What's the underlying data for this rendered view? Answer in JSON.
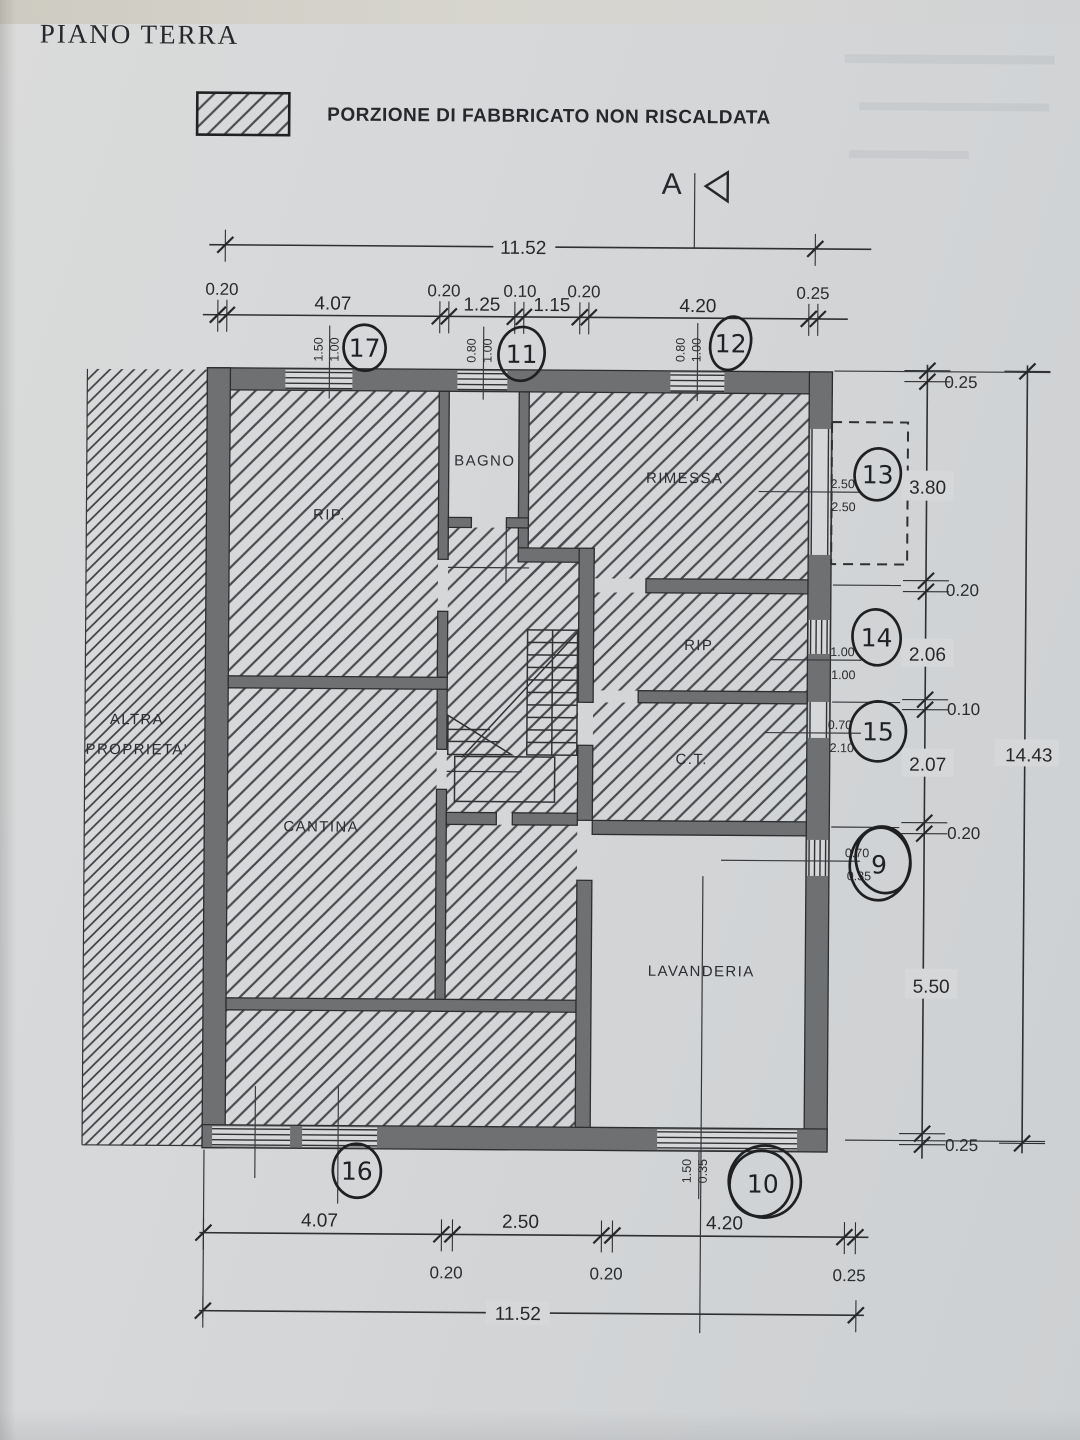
{
  "title": "PIANO TERRA",
  "legend_label": "PORZIONE DI FABBRICATO NON RISCALDATA",
  "section": {
    "label": "A"
  },
  "rooms": {
    "rip1": "RIP.",
    "bagno": "BAGNO",
    "rimessa": "RIMESSA",
    "rip2": "RIP.",
    "ct": "C.T.",
    "cantina": "CANTINA",
    "lavanderia": "LAVANDERIA",
    "altra1": "ALTRA",
    "altra2": "PROPRIETA'"
  },
  "top_dims": {
    "total": "11.52",
    "w1": "0.20",
    "s1": "4.07",
    "w2": "0.20",
    "s2": "1.25",
    "w3": "0.10",
    "s3": "1.15",
    "w4": "0.20",
    "s4": "4.20",
    "w5": "0.25"
  },
  "bottom_dims": {
    "s1": "4.07",
    "s2": "2.50",
    "s3": "4.20",
    "w1": "0.20",
    "w2": "0.20",
    "w3": "0.25",
    "total": "11.52"
  },
  "right_dims": {
    "w1": "0.25",
    "s1": "3.80",
    "w2": "0.20",
    "s2": "2.06",
    "w3": "0.10",
    "s3": "2.07",
    "w4": "0.20",
    "s4": "5.50",
    "w5": "0.25",
    "total": "14.43"
  },
  "openings": {
    "o17": {
      "num": "17",
      "a": "1.50",
      "b": "1.00"
    },
    "o11": {
      "num": "11",
      "a": "0.80",
      "b": "1.00"
    },
    "o12": {
      "num": "12",
      "a": "0.80",
      "b": "1.00"
    },
    "o13": {
      "num": "13",
      "a": "2.50",
      "b": "2.50"
    },
    "o14": {
      "num": "14",
      "a": "1.00",
      "b": "1.00"
    },
    "o15": {
      "num": "15",
      "a": "0.70",
      "b": "2.10"
    },
    "o9": {
      "num": "9",
      "a": "0.70",
      "b": "0.35"
    },
    "o16": {
      "num": "16"
    },
    "o10": {
      "num": "10",
      "a": "1.50",
      "b": "0.35"
    }
  },
  "colors": {
    "paper": "#d4d6d8",
    "ink": "#2e3032",
    "wall_fill": "#6e7072"
  }
}
